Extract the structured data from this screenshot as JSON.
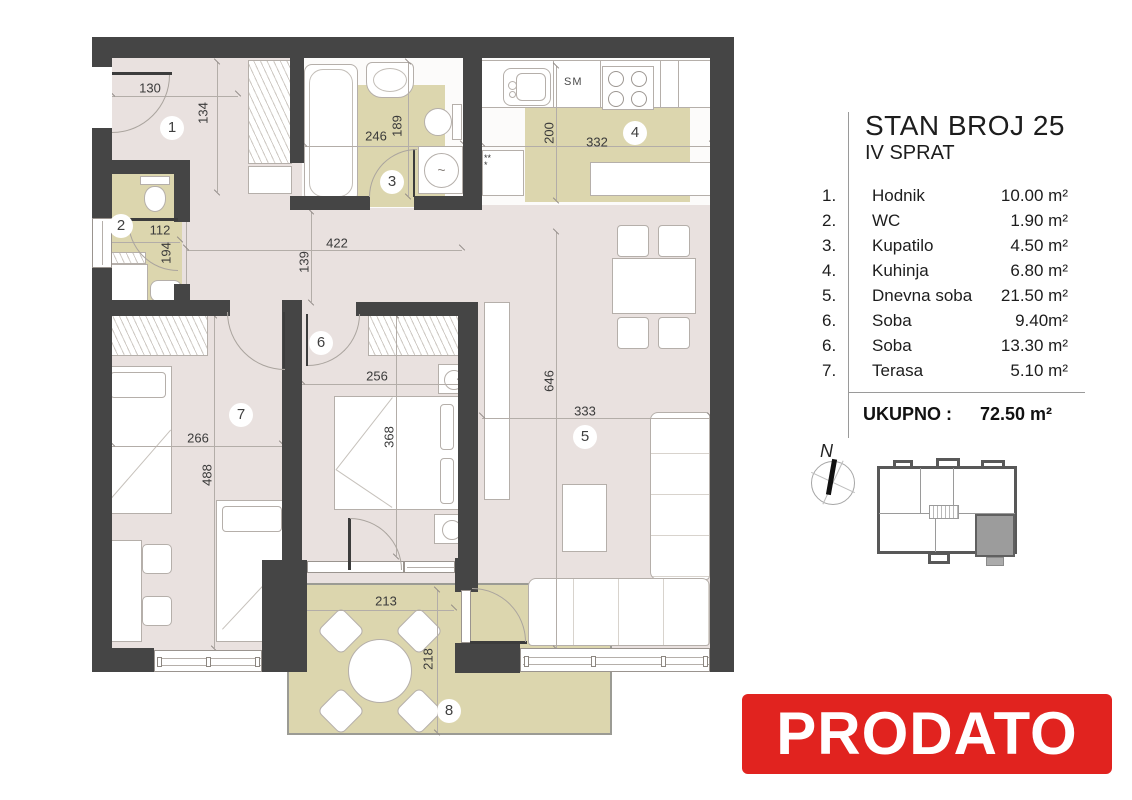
{
  "legend": {
    "title": "STAN BROJ 25",
    "subtitle": "IV SPRAT",
    "rooms": [
      {
        "num": "1.",
        "name": "Hodnik",
        "area": "10.00 m²"
      },
      {
        "num": "2.",
        "name": "WC",
        "area": "1.90 m²"
      },
      {
        "num": "3.",
        "name": "Kupatilo",
        "area": "4.50 m²"
      },
      {
        "num": "4.",
        "name": "Kuhinja",
        "area": "6.80 m²"
      },
      {
        "num": "5.",
        "name": "Dnevna soba",
        "area": "21.50 m²"
      },
      {
        "num": "6.",
        "name": "Soba",
        "area": "9.40m²"
      },
      {
        "num": "6.",
        "name": "Soba",
        "area": "13.30 m²"
      },
      {
        "num": "7.",
        "name": "Terasa",
        "area": "5.10 m²"
      }
    ],
    "total_label": "UKUPNO :",
    "total_value": "72.50 m²"
  },
  "plan": {
    "room_numbers": [
      "1",
      "2",
      "3",
      "4",
      "5",
      "6",
      "7",
      "8"
    ],
    "dims": [
      "130",
      "134",
      "112",
      "194",
      "246",
      "189",
      "200",
      "332",
      "422",
      "139",
      "256",
      "368",
      "266",
      "488",
      "646",
      "333",
      "213",
      "218"
    ],
    "kitchen": {
      "washing_machine_label": "SM",
      "vent_stars": "***"
    }
  },
  "compass": {
    "north_label": "N"
  },
  "banner": {
    "text": "PRODATO"
  },
  "colors": {
    "wall": "#454545",
    "floor": "#e9e1df",
    "wet_floor": "#dcd6ae",
    "banner_bg": "#e1231f",
    "banner_text": "#ffffff",
    "keyplan_highlight": "#9c9c9c"
  }
}
